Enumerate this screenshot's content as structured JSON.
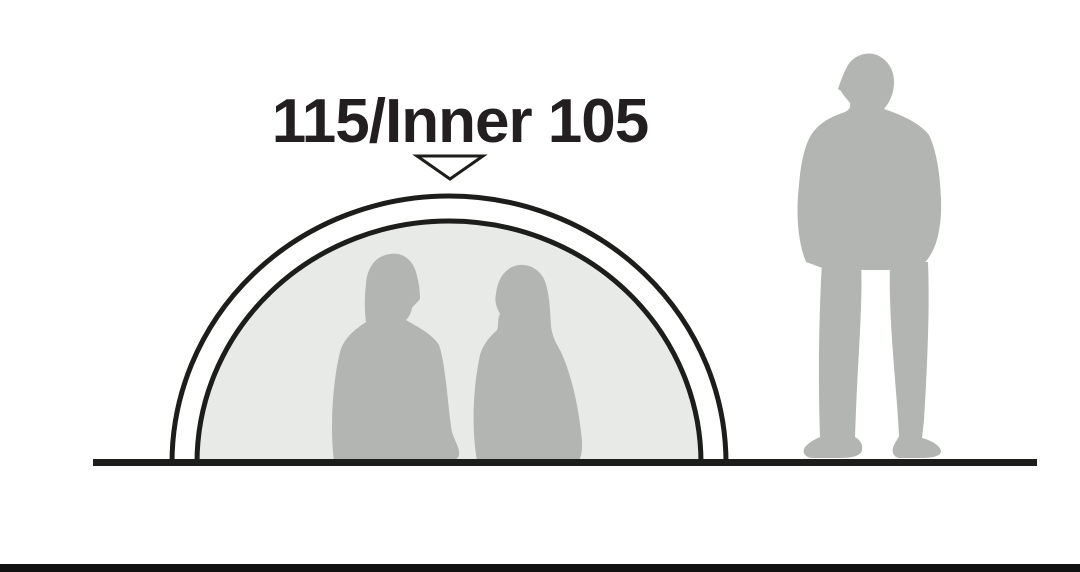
{
  "diagram": {
    "height_label": "115/Inner 105",
    "pointer_icon": "triangle-down-outline"
  },
  "colors": {
    "background": "#ffffff",
    "outline": "#1d1d1b",
    "tent_inner_fill": "#e8eae8",
    "silhouette": "#b3b5b3",
    "ground_line": "#1d1d1b",
    "bottom_bar": "#121212",
    "label_text": "#231f20",
    "pointer_fill": "#ffffff"
  }
}
